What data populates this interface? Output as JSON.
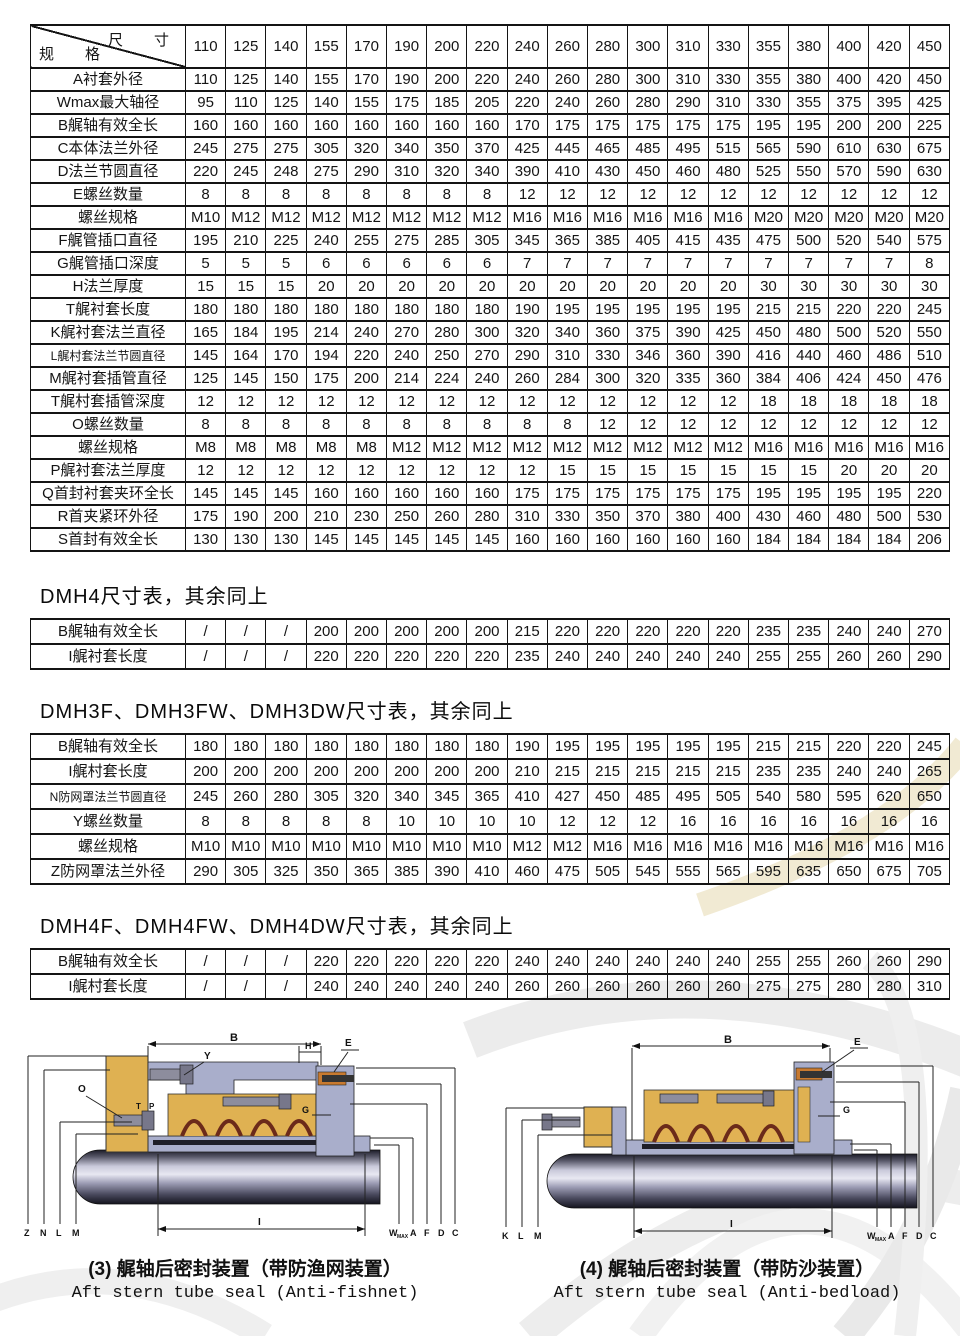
{
  "main_table": {
    "corner": {
      "top_right": "尺　寸",
      "bottom_left": "规　格"
    },
    "columns": [
      "110",
      "125",
      "140",
      "155",
      "170",
      "190",
      "200",
      "220",
      "240",
      "260",
      "280",
      "300",
      "310",
      "330",
      "355",
      "380",
      "400",
      "420",
      "450"
    ],
    "rows": [
      {
        "label": "A衬套外径",
        "values": [
          110,
          125,
          140,
          155,
          170,
          190,
          200,
          220,
          240,
          260,
          280,
          300,
          310,
          330,
          355,
          380,
          400,
          420,
          450
        ]
      },
      {
        "label": "Wmax最大轴径",
        "values": [
          95,
          110,
          125,
          140,
          155,
          175,
          185,
          205,
          220,
          240,
          260,
          280,
          290,
          310,
          330,
          355,
          375,
          395,
          425
        ]
      },
      {
        "label": "B艉轴有效全长",
        "values": [
          160,
          160,
          160,
          160,
          160,
          160,
          160,
          160,
          170,
          175,
          175,
          175,
          175,
          175,
          195,
          195,
          200,
          200,
          225
        ]
      },
      {
        "label": "C本体法兰外径",
        "values": [
          245,
          275,
          275,
          305,
          320,
          340,
          350,
          370,
          425,
          445,
          465,
          485,
          495,
          515,
          565,
          590,
          610,
          630,
          675
        ]
      },
      {
        "label": "D法兰节圆直径",
        "values": [
          220,
          245,
          248,
          275,
          290,
          310,
          320,
          340,
          390,
          410,
          430,
          450,
          460,
          480,
          525,
          550,
          570,
          590,
          630
        ]
      },
      {
        "label": "E螺丝数量",
        "values": [
          8,
          8,
          8,
          8,
          8,
          8,
          8,
          8,
          12,
          12,
          12,
          12,
          12,
          12,
          12,
          12,
          12,
          12,
          12
        ]
      },
      {
        "label": "螺丝规格",
        "values": [
          "M10",
          "M12",
          "M12",
          "M12",
          "M12",
          "M12",
          "M12",
          "M12",
          "M16",
          "M16",
          "M16",
          "M16",
          "M16",
          "M16",
          "M20",
          "M20",
          "M20",
          "M20",
          "M20"
        ]
      },
      {
        "label": "F艉管插口直径",
        "values": [
          195,
          210,
          225,
          240,
          255,
          275,
          285,
          305,
          345,
          365,
          385,
          405,
          415,
          435,
          475,
          500,
          520,
          540,
          575
        ]
      },
      {
        "label": "G艉管插口深度",
        "values": [
          5,
          5,
          5,
          6,
          6,
          6,
          6,
          6,
          7,
          7,
          7,
          7,
          7,
          7,
          7,
          7,
          7,
          7,
          8
        ]
      },
      {
        "label": "H法兰厚度",
        "values": [
          15,
          15,
          15,
          20,
          20,
          20,
          20,
          20,
          20,
          20,
          20,
          20,
          20,
          20,
          30,
          30,
          30,
          30,
          30
        ]
      },
      {
        "label": "T艉衬套长度",
        "values": [
          180,
          180,
          180,
          180,
          180,
          180,
          180,
          180,
          190,
          195,
          195,
          195,
          195,
          195,
          215,
          215,
          220,
          220,
          245
        ]
      },
      {
        "label": "K艉衬套法兰直径",
        "values": [
          165,
          184,
          195,
          214,
          240,
          270,
          280,
          300,
          320,
          340,
          360,
          375,
          390,
          425,
          450,
          480,
          500,
          520,
          550
        ]
      },
      {
        "label": "L艉村套法兰节圆直径",
        "values": [
          145,
          164,
          170,
          194,
          220,
          240,
          250,
          270,
          290,
          310,
          330,
          346,
          360,
          390,
          416,
          440,
          460,
          486,
          510
        ]
      },
      {
        "label": "M艉衬套插管直径",
        "values": [
          125,
          145,
          150,
          175,
          200,
          214,
          224,
          240,
          260,
          284,
          300,
          320,
          335,
          360,
          384,
          406,
          424,
          450,
          476
        ]
      },
      {
        "label": "T艉村套插管深度",
        "values": [
          12,
          12,
          12,
          12,
          12,
          12,
          12,
          12,
          12,
          12,
          12,
          12,
          12,
          12,
          18,
          18,
          18,
          18,
          18
        ]
      },
      {
        "label": "O螺丝数量",
        "values": [
          8,
          8,
          8,
          8,
          8,
          8,
          8,
          8,
          8,
          8,
          12,
          12,
          12,
          12,
          12,
          12,
          12,
          12,
          12
        ]
      },
      {
        "label": "螺丝规格",
        "values": [
          "M8",
          "M8",
          "M8",
          "M8",
          "M8",
          "M12",
          "M12",
          "M12",
          "M12",
          "M12",
          "M12",
          "M12",
          "M12",
          "M12",
          "M16",
          "M16",
          "M16",
          "M16",
          "M16"
        ]
      },
      {
        "label": "P艉衬套法兰厚度",
        "values": [
          12,
          12,
          12,
          12,
          12,
          12,
          12,
          12,
          12,
          15,
          15,
          15,
          15,
          15,
          15,
          15,
          20,
          20,
          20
        ]
      },
      {
        "label": "Q首封衬套夹环全长",
        "values": [
          145,
          145,
          145,
          160,
          160,
          160,
          160,
          160,
          175,
          175,
          175,
          175,
          175,
          175,
          195,
          195,
          195,
          195,
          220
        ]
      },
      {
        "label": "R首夹紧环外径",
        "values": [
          175,
          190,
          200,
          210,
          230,
          250,
          260,
          280,
          310,
          330,
          350,
          370,
          380,
          400,
          430,
          460,
          480,
          500,
          530
        ]
      },
      {
        "label": "S首封有效全长",
        "values": [
          130,
          130,
          130,
          145,
          145,
          145,
          145,
          145,
          160,
          160,
          160,
          160,
          160,
          160,
          184,
          184,
          184,
          184,
          206
        ]
      }
    ]
  },
  "sections": [
    {
      "heading": "DMH4尺寸表，其余同上",
      "rows": [
        {
          "label": "B艉轴有效全长",
          "values": [
            "/",
            "/",
            "/",
            200,
            200,
            200,
            200,
            200,
            215,
            220,
            220,
            220,
            220,
            220,
            235,
            235,
            240,
            240,
            270
          ]
        },
        {
          "label": "I艉衬套长度",
          "values": [
            "/",
            "/",
            "/",
            220,
            220,
            220,
            220,
            220,
            235,
            240,
            240,
            240,
            240,
            240,
            255,
            255,
            260,
            260,
            290
          ]
        }
      ]
    },
    {
      "heading": "DMH3F、DMH3FW、DMH3DW尺寸表，其余同上",
      "rows": [
        {
          "label": "B艉轴有效全长",
          "values": [
            180,
            180,
            180,
            180,
            180,
            180,
            180,
            180,
            190,
            195,
            195,
            195,
            195,
            195,
            215,
            215,
            220,
            220,
            245
          ]
        },
        {
          "label": "I艉村套长度",
          "values": [
            200,
            200,
            200,
            200,
            200,
            200,
            200,
            200,
            210,
            215,
            215,
            215,
            215,
            215,
            235,
            235,
            240,
            240,
            265
          ]
        },
        {
          "label": "N防网罩法兰节圆直径",
          "values": [
            245,
            260,
            280,
            305,
            320,
            340,
            345,
            365,
            410,
            427,
            450,
            485,
            495,
            505,
            540,
            580,
            595,
            620,
            650
          ]
        },
        {
          "label": "Y螺丝数量",
          "values": [
            8,
            8,
            8,
            8,
            8,
            10,
            10,
            10,
            10,
            12,
            12,
            12,
            16,
            16,
            16,
            16,
            16,
            16,
            16
          ]
        },
        {
          "label": "螺丝规格",
          "values": [
            "M10",
            "M10",
            "M10",
            "M10",
            "M10",
            "M10",
            "M10",
            "M10",
            "M12",
            "M12",
            "M16",
            "M16",
            "M16",
            "M16",
            "M16",
            "M16",
            "M16",
            "M16",
            "M16"
          ]
        },
        {
          "label": "Z防网罩法兰外径",
          "values": [
            290,
            305,
            325,
            350,
            365,
            385,
            390,
            410,
            460,
            475,
            505,
            545,
            555,
            565,
            595,
            635,
            650,
            675,
            705
          ]
        }
      ]
    },
    {
      "heading": "DMH4F、DMH4FW、DMH4DW尺寸表，其余同上",
      "rows": [
        {
          "label": "B艉轴有效全长",
          "values": [
            "/",
            "/",
            "/",
            220,
            220,
            220,
            220,
            220,
            240,
            240,
            240,
            240,
            240,
            240,
            255,
            255,
            260,
            260,
            290
          ]
        },
        {
          "label": "I艉村套长度",
          "values": [
            "/",
            "/",
            "/",
            240,
            240,
            240,
            240,
            240,
            260,
            260,
            260,
            260,
            260,
            260,
            275,
            275,
            280,
            280,
            310
          ]
        }
      ]
    }
  ],
  "drawings": {
    "left": {
      "caption_zh": "(3) 艉轴后密封装置（带防渔网装置）",
      "caption_en": "Aft stern tube seal (Anti-fishnet)",
      "labels": {
        "B": "B",
        "Y": "Y",
        "H": "H",
        "E": "E",
        "O": "O",
        "T": "T",
        "P": "P",
        "G": "G",
        "Z": "Z",
        "N": "N",
        "L": "L",
        "M": "M",
        "I": "I",
        "W": "W",
        "WSUB": "MAX",
        "A": "A",
        "F": "F",
        "D": "D",
        "C": "C"
      }
    },
    "right": {
      "caption_zh": "(4) 艉轴后密封装置（带防沙装置）",
      "caption_en": "Aft stern tube seal (Anti-bedload)",
      "labels": {
        "B": "B",
        "E": "E",
        "G": "G",
        "K": "K",
        "L": "L",
        "M": "M",
        "I": "I",
        "W": "W",
        "WSUB": "MAX",
        "A": "A",
        "F": "F",
        "D": "D",
        "C": "C"
      }
    }
  },
  "colors": {
    "table_line": "#141414",
    "housing_yellow": "#dfb152",
    "seal_red": "#6b2a1a",
    "flange_gray": "#a9aecb",
    "bolt_gray": "#8d8d9d",
    "copper": "#c87a30",
    "watermark_gray": "#ececec",
    "watermark_cream": "#f1ead3"
  }
}
